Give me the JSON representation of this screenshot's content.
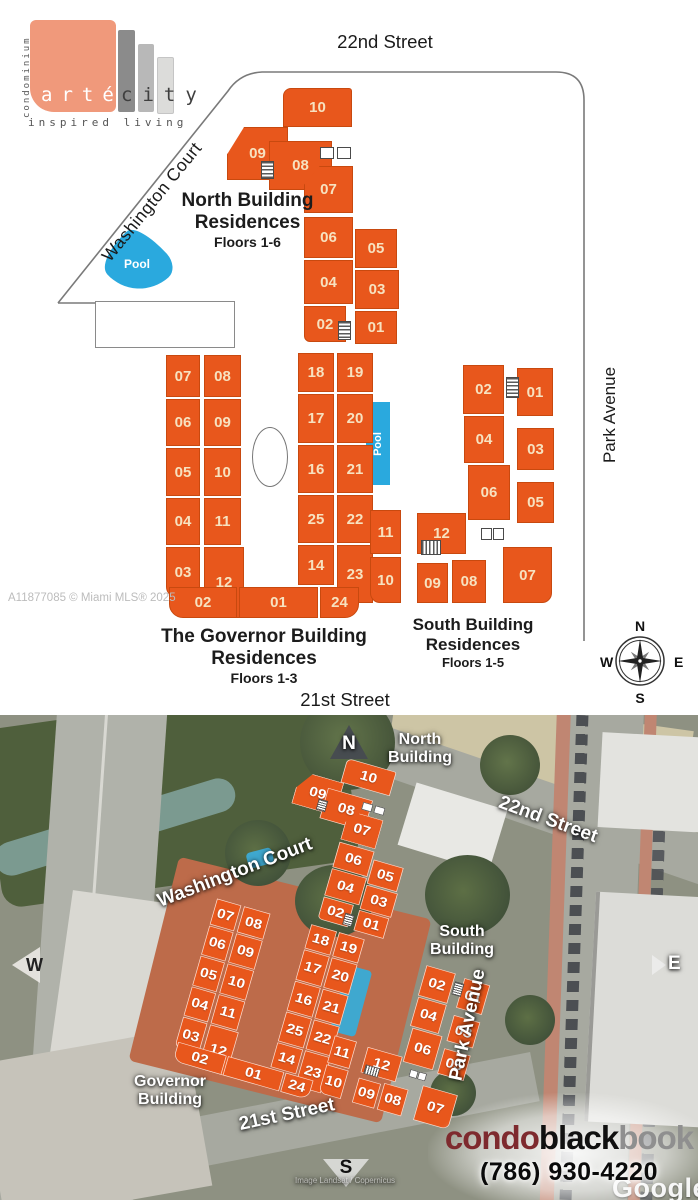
{
  "logo": {
    "vertical": "condominium",
    "arte": "arté",
    "city": "city",
    "tagline": "inspired living"
  },
  "colors": {
    "unit_orange": "#E8571C",
    "pool_blue": "#2AA9DE",
    "logo_salmon": "#F0997B"
  },
  "plan": {
    "street_top": "22nd Street",
    "street_bottom": "21st  Street",
    "street_right": "Park Avenue",
    "street_diagonal": "Washington Court",
    "watermark": "A11877085 © Miami MLS® 2025",
    "pool_label": "Pool",
    "compass": {
      "n": "N",
      "e": "E",
      "s": "S",
      "w": "W"
    },
    "north": {
      "line1": "North Building",
      "line2": "Residences",
      "line3": "Floors 1-6",
      "units": {
        "u10": "10",
        "u09": "09",
        "u08": "08",
        "u07": "07",
        "u06": "06",
        "u04": "04",
        "u02": "02",
        "u05": "05",
        "u03": "03",
        "u01": "01"
      }
    },
    "governor": {
      "line1": "The Governor Building",
      "line2": "Residences",
      "line3": "Floors 1-3",
      "units": {
        "u07": "07",
        "u08": "08",
        "u06": "06",
        "u09": "09",
        "u05": "05",
        "u10": "10",
        "u04": "04",
        "u11": "11",
        "u03": "03",
        "u12": "12",
        "u18": "18",
        "u19": "19",
        "u17": "17",
        "u20": "20",
        "u16": "16",
        "u21": "21",
        "u25": "25",
        "u22": "22",
        "u14": "14",
        "u23": "23",
        "u02": "02",
        "u01": "01",
        "u24": "24"
      }
    },
    "south": {
      "line1": "South Building",
      "line2": "Residences",
      "line3": "Floors 1-5",
      "units": {
        "u02": "02",
        "u01": "01",
        "u04": "04",
        "u03": "03",
        "u06": "06",
        "u05": "05",
        "u11": "11",
        "u12": "12",
        "u10": "10",
        "u09": "09",
        "u08": "08",
        "u07": "07"
      }
    }
  },
  "aerial": {
    "labels": {
      "north_building_1": "North",
      "north_building_2": "Building",
      "south_building_1": "South",
      "south_building_2": "Building",
      "governor_building_1": "Governor",
      "governor_building_2": "Building",
      "street_22nd": "22nd Street",
      "street_21st": "21st Street",
      "washington_court": "Washington Court",
      "park_avenue": "Park Avenue"
    },
    "compass": {
      "n": "N",
      "e": "E",
      "s": "S",
      "w": "W"
    },
    "branding": {
      "condo": "condo",
      "black": "black",
      "book": "book",
      "phone": "(786) 930-4220"
    },
    "google": "Google",
    "attribution": "Image Landsat / Copernicus"
  }
}
